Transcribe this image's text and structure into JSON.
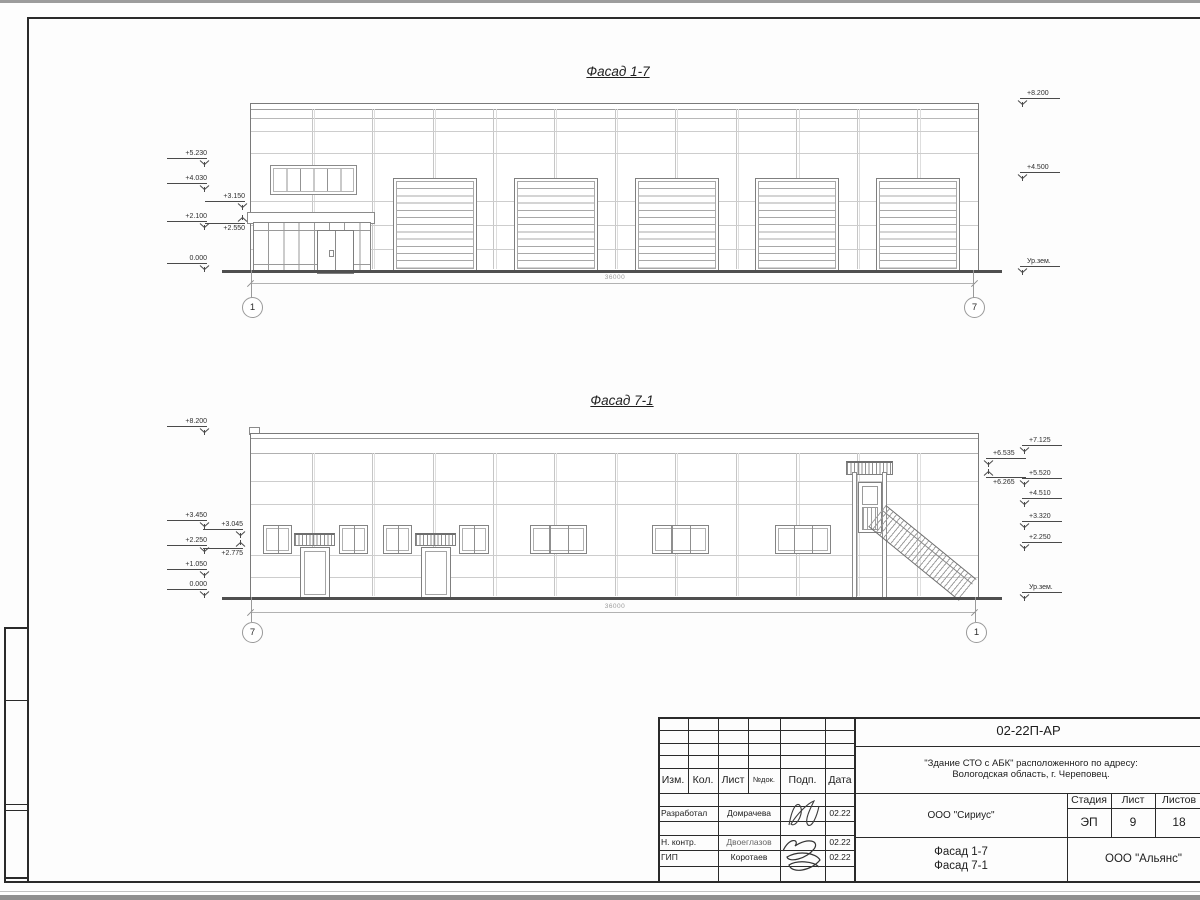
{
  "sheet": {
    "facade_top": {
      "title": "Фасад 1-7",
      "dim": "36000",
      "axis_left": "1",
      "axis_right": "7",
      "marks": [
        {
          "t": "+5.230",
          "x": 207,
          "y": 159,
          "side": "l"
        },
        {
          "t": "+4.030",
          "x": 207,
          "y": 184,
          "side": "l"
        },
        {
          "t": "+3.150",
          "x": 245,
          "y": 202,
          "side": "l"
        },
        {
          "t": "+2.100",
          "x": 207,
          "y": 222,
          "side": "l"
        },
        {
          "t": "+2.550",
          "x": 245,
          "y": 223,
          "side": "l",
          "flip": true
        },
        {
          "t": "0.000",
          "x": 207,
          "y": 264,
          "side": "l"
        },
        {
          "t": "+8.200",
          "x": 1020,
          "y": 99,
          "side": "r"
        },
        {
          "t": "+4.500",
          "x": 1020,
          "y": 173,
          "side": "r"
        },
        {
          "t": "Ур.зем.",
          "x": 1020,
          "y": 267,
          "side": "r"
        }
      ]
    },
    "facade_bottom": {
      "title": "Фасад 7-1",
      "dim": "36000",
      "axis_left": "7",
      "axis_right": "1",
      "marks": [
        {
          "t": "+8.200",
          "x": 207,
          "y": 427,
          "side": "l"
        },
        {
          "t": "+3.450",
          "x": 207,
          "y": 521,
          "side": "l"
        },
        {
          "t": "+3.045",
          "x": 243,
          "y": 530,
          "side": "l"
        },
        {
          "t": "+2.250",
          "x": 207,
          "y": 546,
          "side": "l"
        },
        {
          "t": "+2.775",
          "x": 243,
          "y": 548,
          "side": "l",
          "flip": true
        },
        {
          "t": "+1.050",
          "x": 207,
          "y": 570,
          "side": "l"
        },
        {
          "t": "0.000",
          "x": 207,
          "y": 590,
          "side": "l"
        },
        {
          "t": "+7.125",
          "x": 1022,
          "y": 446,
          "side": "r"
        },
        {
          "t": "+6.535",
          "x": 986,
          "y": 459,
          "side": "r"
        },
        {
          "t": "+5.520",
          "x": 1022,
          "y": 479,
          "side": "r"
        },
        {
          "t": "+6.265",
          "x": 986,
          "y": 477,
          "side": "r",
          "flip": true
        },
        {
          "t": "+4.510",
          "x": 1022,
          "y": 499,
          "side": "r"
        },
        {
          "t": "+3.320",
          "x": 1022,
          "y": 522,
          "side": "r"
        },
        {
          "t": "+2.250",
          "x": 1022,
          "y": 543,
          "side": "r"
        },
        {
          "t": "Ур.зем.",
          "x": 1022,
          "y": 593,
          "side": "r"
        }
      ]
    }
  },
  "titleblock": {
    "doc_number": "02-22П-АР",
    "project_address_line1": "\"Здание СТО с АБК\" расположенного по адресу:",
    "project_address_line2": "Вологодская область, г. Череповец.",
    "designer_org": "ООО \"Сириус\"",
    "client_org": "ООО \"Альянс\"",
    "sheet_title_line1": "Фасад 1-7",
    "sheet_title_line2": "Фасад 7-1",
    "stage_label": "Стадия",
    "sheet_label": "Лист",
    "sheets_label": "Листов",
    "stage": "ЭП",
    "sheet_no": "9",
    "sheets_total": "18",
    "columns": {
      "izm": "Изм.",
      "kol": "Кол.",
      "list": "Лист",
      "ndok": "№док.",
      "podp": "Подп.",
      "data": "Дата"
    },
    "rows": [
      {
        "role": "Разработал",
        "name": "Домрачева",
        "date": "02.22"
      },
      {
        "role": "Н. контр.",
        "name": "Двоеглазов",
        "date": "02.22"
      },
      {
        "role": "ГИП",
        "name": "Коротаев",
        "date": "02.22"
      }
    ]
  }
}
